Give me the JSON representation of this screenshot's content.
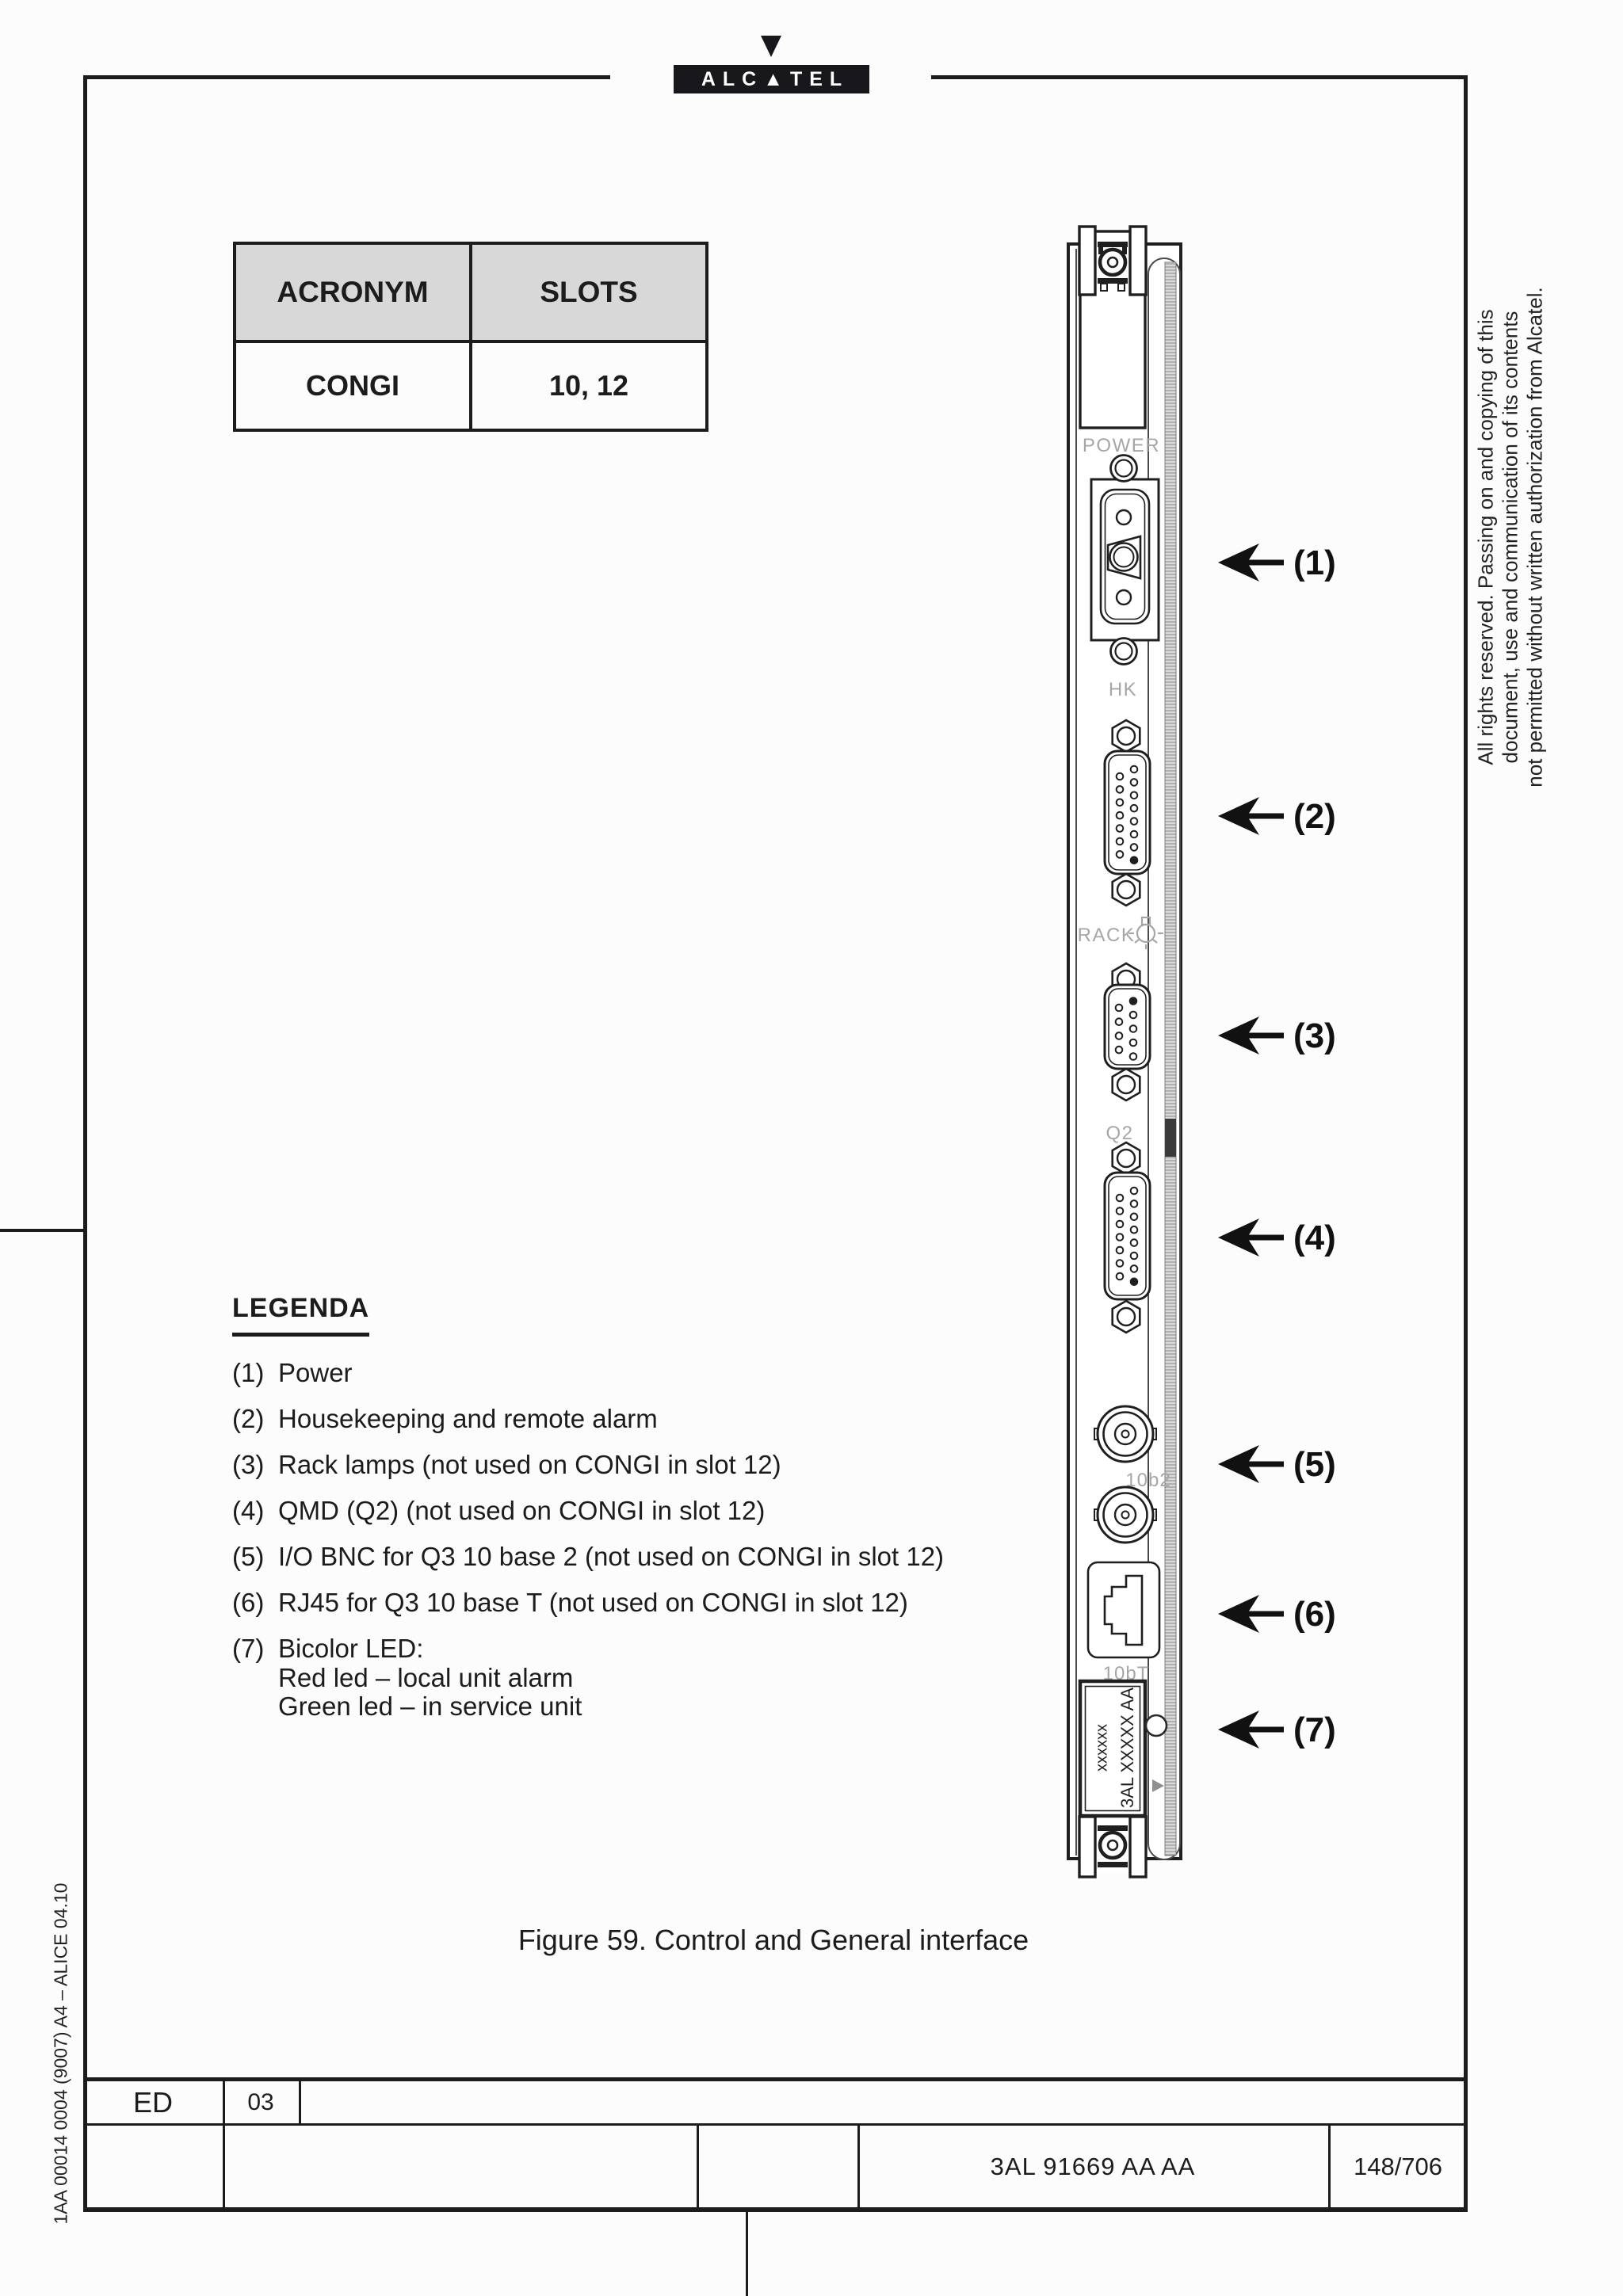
{
  "page": {
    "logo_wordmark": "ALC▲TEL",
    "figure_caption": "Figure 59. Control and General interface",
    "side_code": "1AA 00014 0004 (9007) A4 – ALICE 04.10",
    "rights_lines": [
      "All rights reserved. Passing on and copying of this",
      "document, use and communication of its contents",
      "not permitted without written authorization from Alcatel."
    ]
  },
  "info_table": {
    "col1_header": "ACRONYM",
    "col2_header": "SLOTS",
    "row": {
      "acronym": "CONGI",
      "slots": "10, 12"
    }
  },
  "board": {
    "labels": {
      "power": "POWER",
      "hk": "HK",
      "rack": "RACK",
      "q2": "Q2",
      "tenb2": "10b2",
      "tenbt": "10bT"
    },
    "unit_code_main": "3AL XXXXX AA",
    "unit_code_small": "xxxxxx"
  },
  "callouts": [
    "(1)",
    "(2)",
    "(3)",
    "(4)",
    "(5)",
    "(6)",
    "(7)"
  ],
  "legend": {
    "title": "LEGENDA",
    "items": [
      {
        "num": "(1)",
        "text": "Power"
      },
      {
        "num": "(2)",
        "text": "Housekeeping and remote alarm"
      },
      {
        "num": "(3)",
        "text": "Rack lamps (not used on CONGI in slot 12)"
      },
      {
        "num": "(4)",
        "text": "QMD (Q2) (not used on CONGI in slot 12)"
      },
      {
        "num": "(5)",
        "text": "I/O BNC for Q3 10 base 2 (not used on CONGI in slot 12)"
      },
      {
        "num": "(6)",
        "text": "RJ45 for Q3 10 base T (not used on CONGI in slot 12)"
      },
      {
        "num": "(7)",
        "text": "Bicolor LED:"
      }
    ],
    "item7_sub": [
      "Red led – local unit alarm",
      "Green led – in service unit"
    ]
  },
  "footer": {
    "ed_label": "ED",
    "ed_value": "03",
    "doc_code": "3AL 91669 AA AA",
    "page_ref": "148/706"
  }
}
